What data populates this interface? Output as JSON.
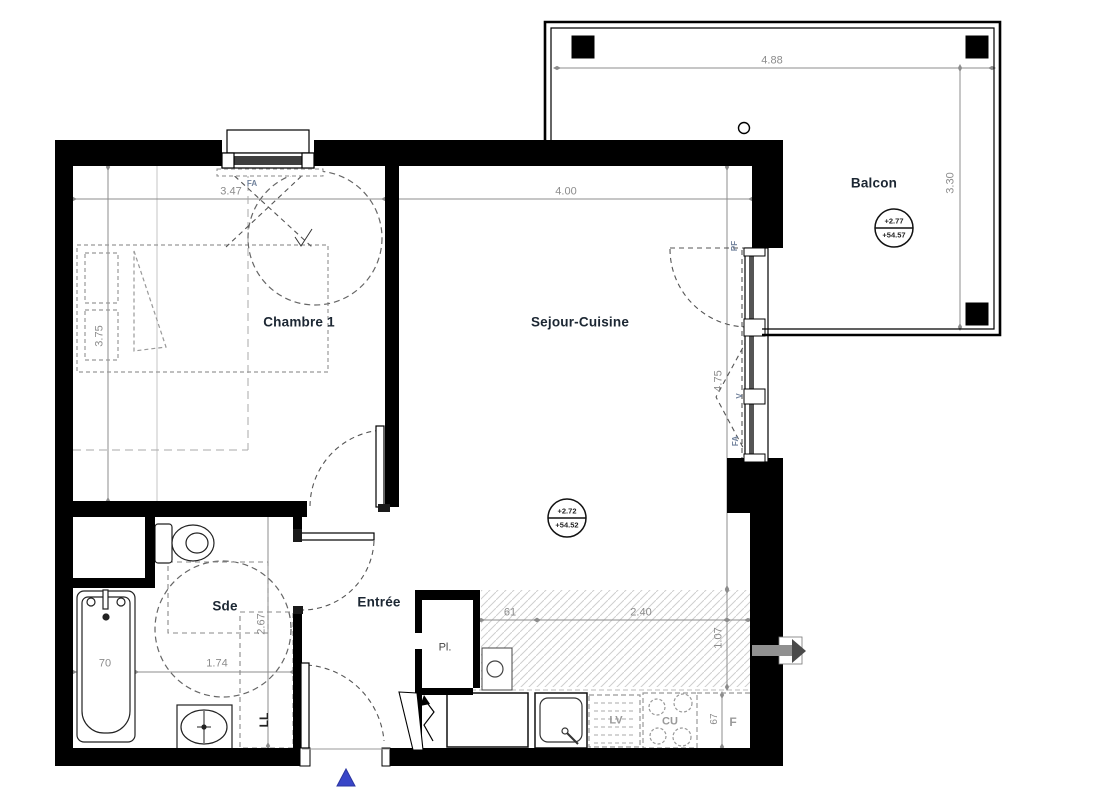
{
  "floor_plan": {
    "rooms": [
      {
        "name": "Chambre 1",
        "width_m": "3.47",
        "depth_m": "3.75"
      },
      {
        "name": "Sejour-Cuisine",
        "width_m": "4.00",
        "depth_m": "4.75"
      },
      {
        "name": "Balcon",
        "width_m": "4.88",
        "depth_m": "3.30"
      },
      {
        "name": "Sde",
        "width_m": "1.74",
        "depth_m": "2.67"
      },
      {
        "name": "Entrée"
      }
    ],
    "levels": [
      {
        "room": "Sejour-Cuisine",
        "level": "+2.72",
        "altitude": "+54.52"
      },
      {
        "room": "Balcon",
        "level": "+2.77",
        "altitude": "+54.57"
      }
    ],
    "other_dimensions": {
      "bathtub_width": "70",
      "kitchen_offset": "61",
      "kitchen_run": "2.40",
      "kitchen_depth": "1.07",
      "fridge_width": "67"
    },
    "openings": {
      "bedroom_window": "FA",
      "balcony_door": "PF",
      "vent_sash": "V",
      "tilt_sash": "FA"
    },
    "equipment": {
      "closet": "Pl.",
      "washer": "LL",
      "dishwasher": "LV",
      "cooktop": "CU",
      "fridge": "F"
    },
    "colors": {
      "walls": "#000000",
      "dimensions": "#8c8c8c",
      "room_labels": "#1c2733",
      "opening_labels": "#70819b",
      "north_arrow": "#3946c8",
      "kitchen_hatch": "#cfcfcf"
    }
  }
}
